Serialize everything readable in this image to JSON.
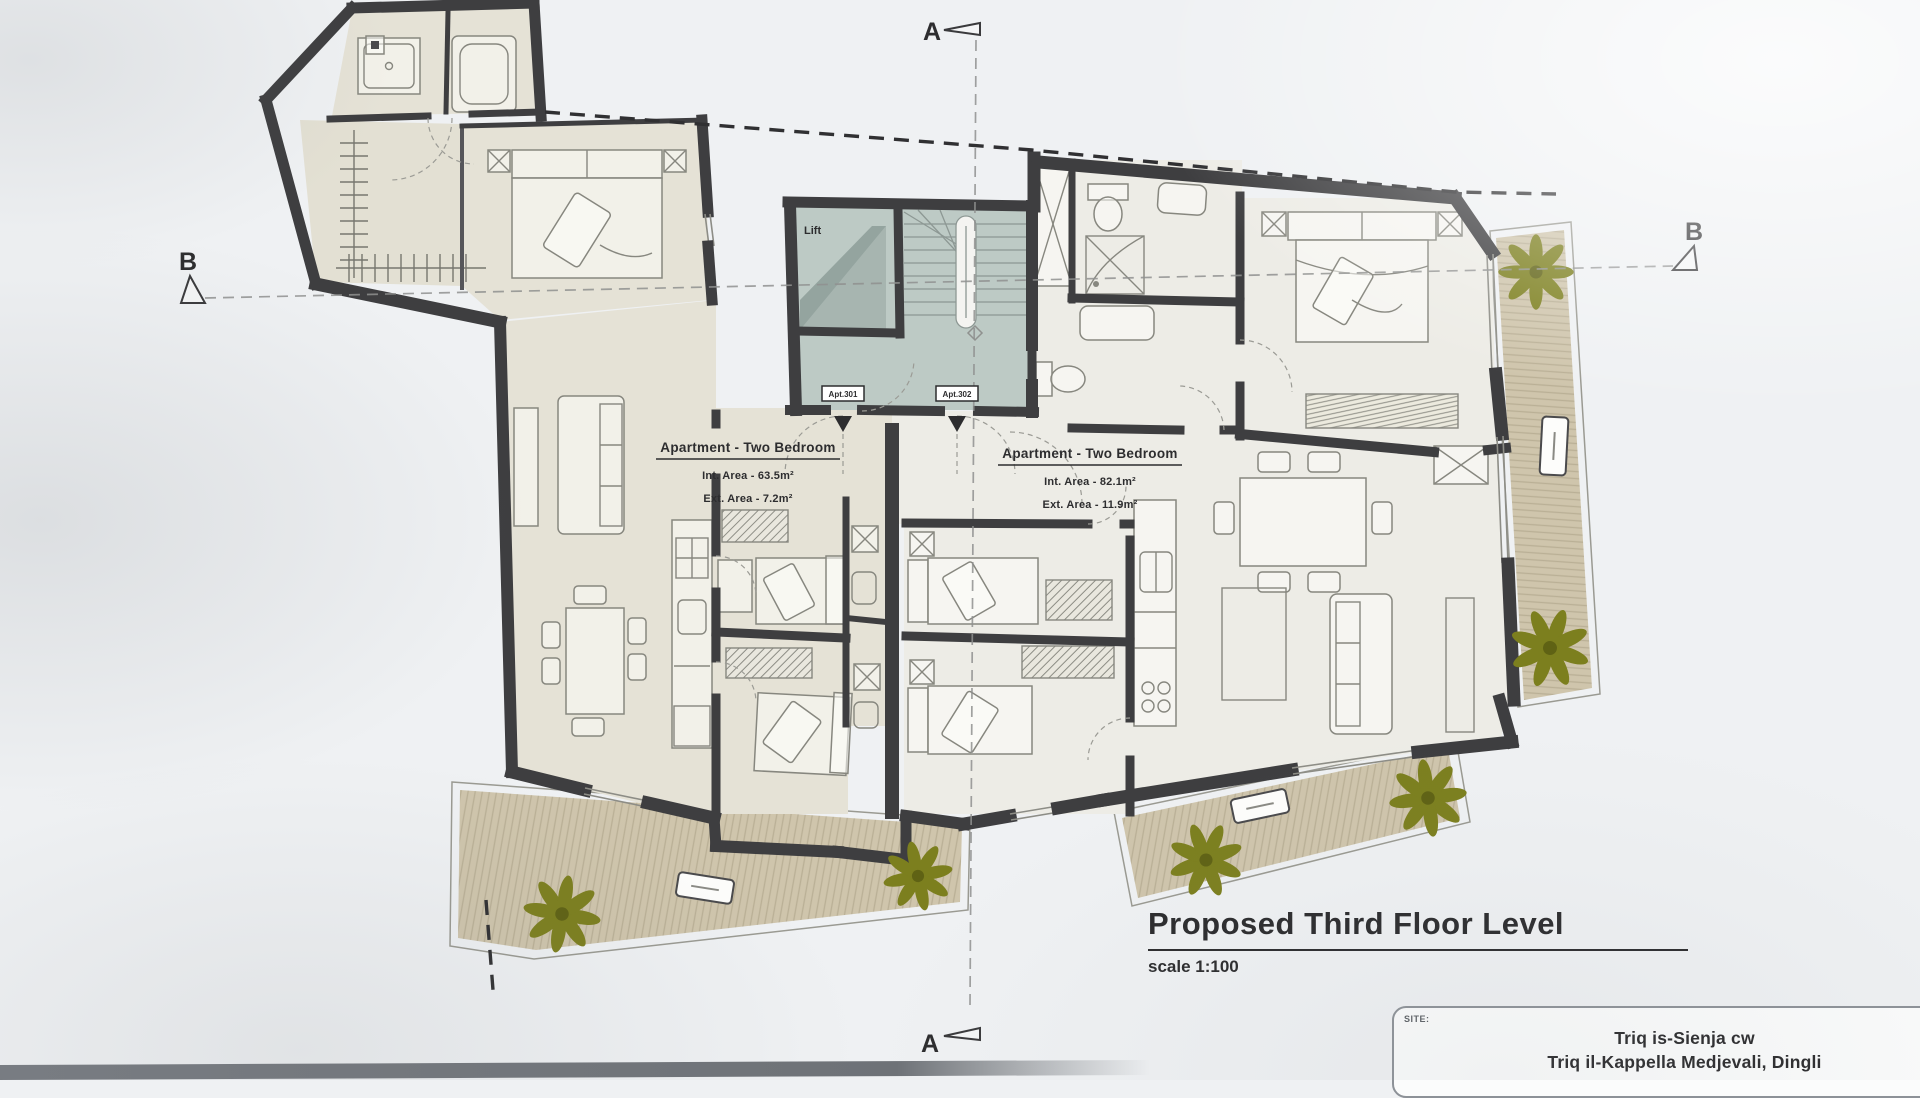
{
  "drawing": {
    "title": "Proposed Third Floor Level",
    "scale": "scale 1:100",
    "site": {
      "label": "SITE:",
      "line1": "Triq is-Sienja cw",
      "line2": "Triq il-Kappella Medjevali, Dingli"
    }
  },
  "sections": {
    "a": "A",
    "b": "B"
  },
  "core": {
    "lift": "Lift"
  },
  "apartments": [
    {
      "tag": "Apt.301",
      "type": "Apartment - Two Bedroom",
      "int_area": "Int. Area - 63.5m²",
      "ext_area": "Ext. Area - 7.2m²"
    },
    {
      "tag": "Apt.302",
      "type": "Apartment - Two Bedroom",
      "int_area": "Int. Area - 82.1m²",
      "ext_area": "Ext. Area - 11.9m²"
    }
  ],
  "colors": {
    "wall": "#3e3e40",
    "core_floor": "#bdcac5",
    "floor_left_wing": "#e5e2d6",
    "floor_right_wing": "#edece6",
    "deck": "#cfc5ac",
    "plant": "#7c7f1e",
    "paper": "#eff1f3",
    "ink": "#2d2d2f"
  }
}
